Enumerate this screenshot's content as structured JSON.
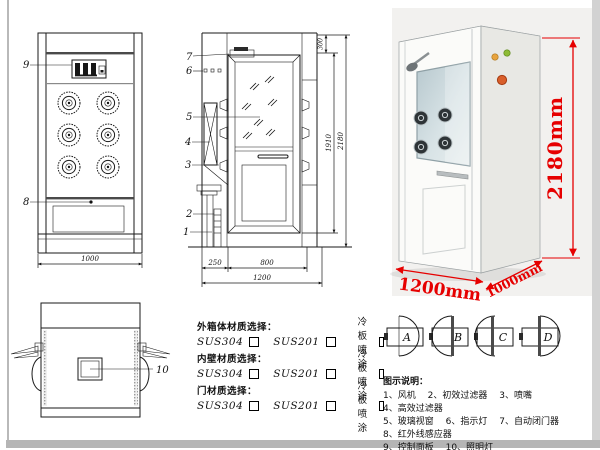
{
  "colors": {
    "dim_red": "#e60000",
    "line": "#1a1a1a"
  },
  "front_view": {
    "label_9": "9",
    "label_8": "8",
    "dim_width": "1000"
  },
  "side_view": {
    "label_7": "7",
    "label_6": "6",
    "label_5": "5",
    "label_4": "4",
    "label_3": "3",
    "label_2": "2",
    "label_1": "1",
    "dim_top": "300",
    "dim_opening_h": "1910",
    "dim_total_h": "2180",
    "dim_side": "250",
    "dim_door_w": "800",
    "dim_total_w": "1200"
  },
  "photo": {
    "dim_height": "2180mm",
    "dim_width": "1200mm",
    "dim_depth": "1000mm"
  },
  "top_view": {
    "label_10": "10"
  },
  "materials": {
    "groups": [
      {
        "title": "外箱体材质选择：",
        "options": [
          {
            "label": "SUS304"
          },
          {
            "label": "SUS201"
          },
          {
            "label": "冷板喷涂"
          }
        ]
      },
      {
        "title": "内壁材质选择：",
        "options": [
          {
            "label": "SUS304"
          },
          {
            "label": "SUS201"
          },
          {
            "label": "冷板喷涂"
          }
        ]
      },
      {
        "title": "门材质选择：",
        "options": [
          {
            "label": "SUS304"
          },
          {
            "label": "SUS201"
          },
          {
            "label": "冷板喷涂"
          }
        ]
      }
    ]
  },
  "door_options": {
    "a": "A",
    "b": "B",
    "c": "C",
    "d": "D"
  },
  "legend": {
    "title": "图示说明：",
    "items": [
      "1、风机",
      "2、初效过滤器",
      "3、喷嘴",
      "4、高效过滤器",
      "5、玻璃视窗",
      "6、指示灯",
      "7、自动闭门器",
      "8、红外线感应器",
      "9、控制面板",
      "10、照明灯"
    ]
  }
}
